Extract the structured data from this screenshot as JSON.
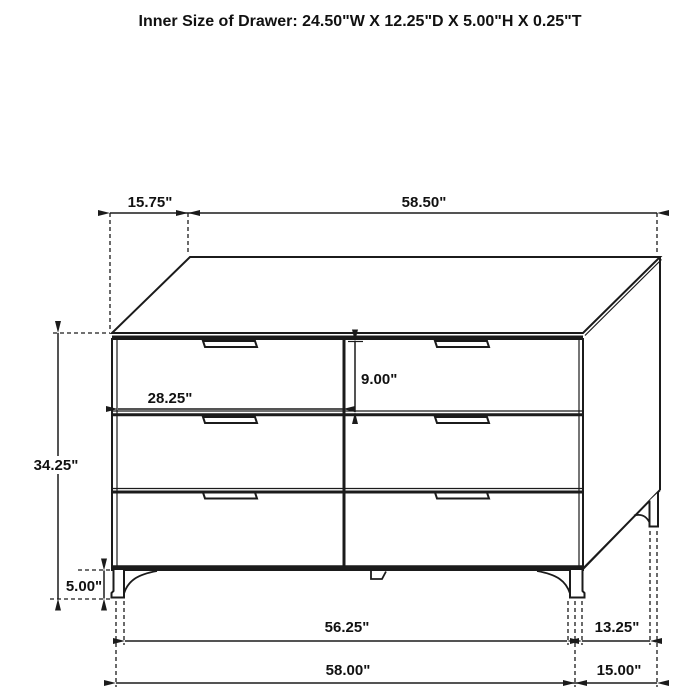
{
  "header": {
    "title": "Inner Size of Drawer: 24.50\"W X 12.25\"D X 5.00\"H X 0.25\"T"
  },
  "drawing": {
    "subject": "six-drawer-dresser-technical-line-drawing",
    "drawer_rows": 3,
    "drawer_columns": 2
  },
  "dim_labels": {
    "top_depth_offset": "15.75\"",
    "top_width": "58.50\"",
    "drawer_width": "28.25\"",
    "drawer_height": "9.00\"",
    "cabinet_height": "34.25\"",
    "leg_height": "5.00\"",
    "front_leg_span": "56.25\"",
    "base_width": "58.00\"",
    "side_leg_gap": "13.25\"",
    "side_depth_span": "15.00\""
  },
  "colors": {
    "line": "#1b1b1b",
    "background": "#ffffff",
    "text": "#111111"
  }
}
